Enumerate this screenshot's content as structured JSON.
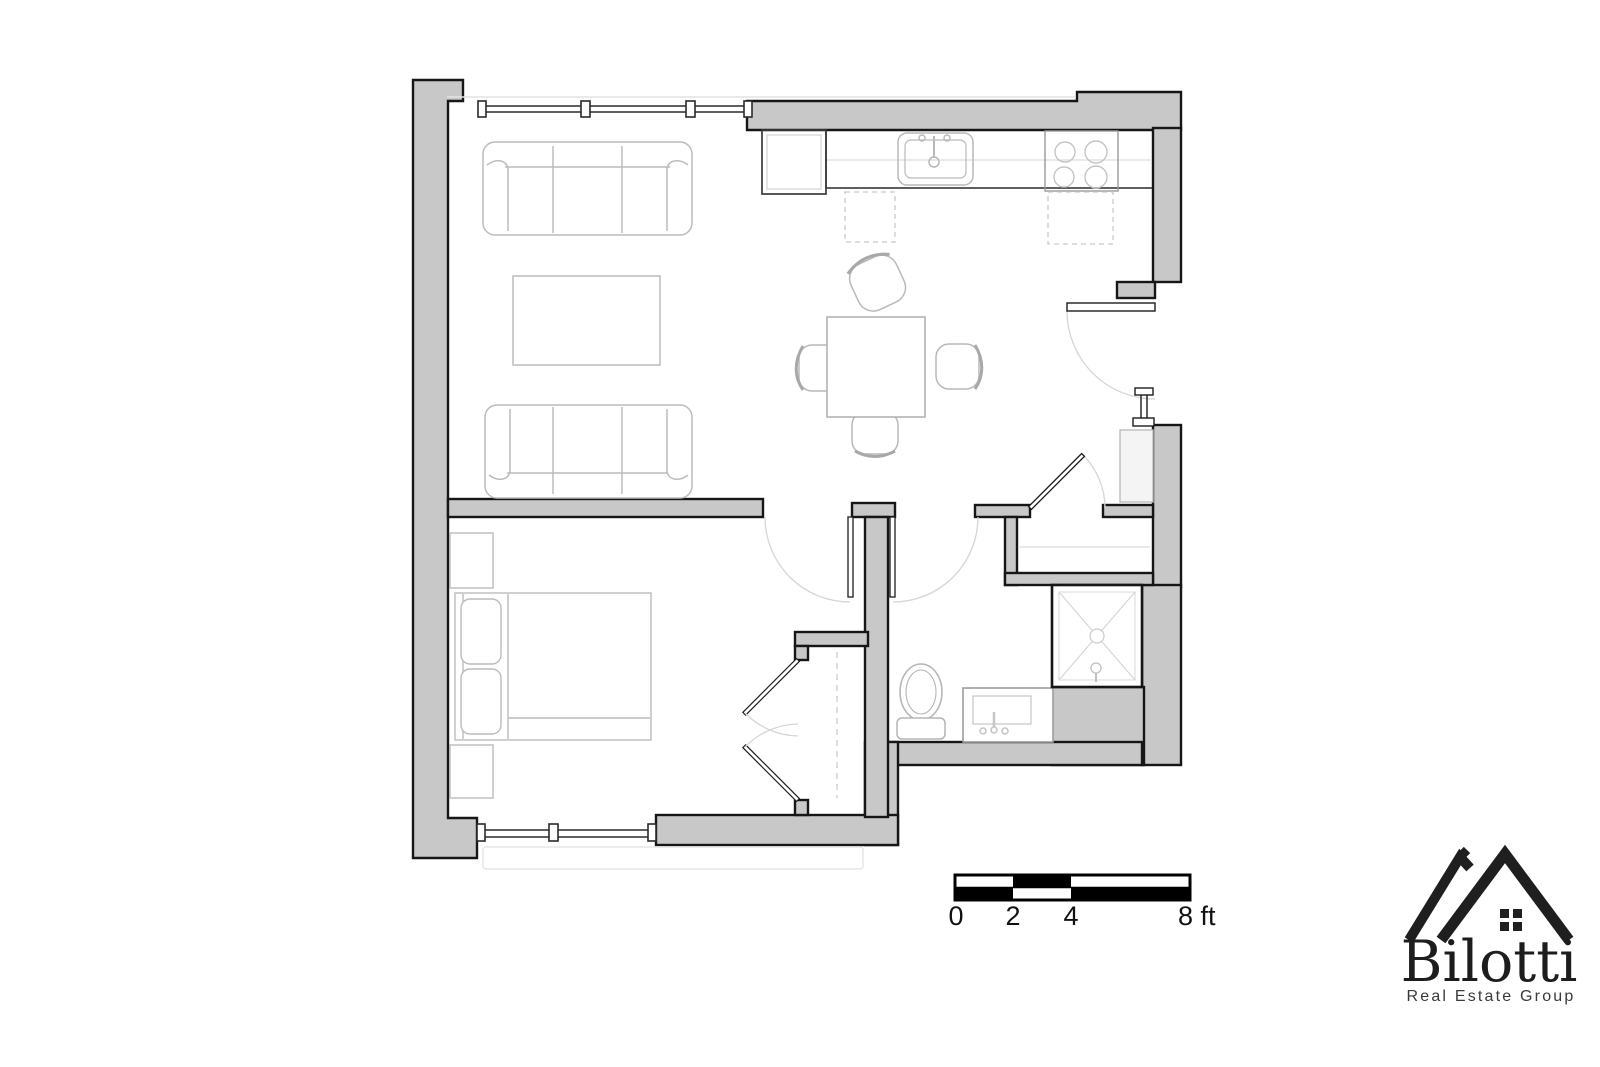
{
  "page": {
    "background": "#ffffff"
  },
  "plan": {
    "wall_fill": "#c8c8c8",
    "wall_outline": "#161616",
    "furniture_line": "#bcbcbc",
    "door_arc_color": "#d6d6d6",
    "fixtures": [
      "sofa",
      "loveseat",
      "coffee-table",
      "kitchen-counter",
      "refrigerator",
      "kitchen-sink",
      "cooktop",
      "dishwasher",
      "dining-table",
      "dining-chair",
      "bed",
      "nightstand",
      "wardrobe-closet",
      "entry-closet",
      "toilet",
      "vanity-sink",
      "shower",
      "windows",
      "entry-door"
    ]
  },
  "scale_bar": {
    "unit": "ft",
    "ticks_ft": [
      0,
      2,
      4,
      8
    ],
    "labels": {
      "zero": "0",
      "two": "2",
      "four": "4",
      "eight": "8 ft"
    }
  },
  "logo": {
    "brand": "Bilotti",
    "tagline": "Real Estate Group"
  }
}
